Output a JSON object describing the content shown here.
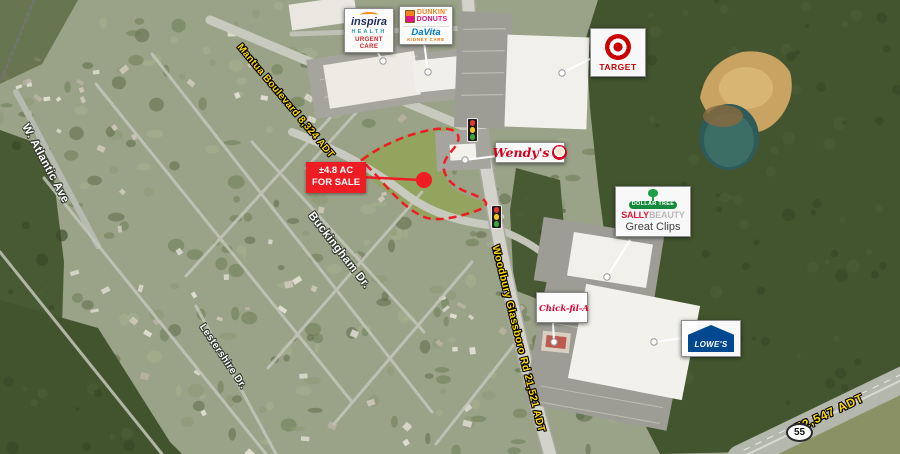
{
  "for_sale": {
    "area": "±4.8 AC",
    "label": "FOR SALE"
  },
  "roads": {
    "mantua": "Mantua Boulevard 8,324 ADT",
    "woodbury": "Woodbury Glassboro Rd 21,521 ADT",
    "highway_adt": "72,547 ADT",
    "route_number": "55"
  },
  "streets": {
    "atlantic": "W. Atlantic Ave",
    "buckingham": "Buckingham Dr.",
    "lestershire": "Lestershire Dr."
  },
  "businesses": {
    "inspira": {
      "name": "inspira",
      "division": "HEALTH",
      "tagline": "URGENT CARE"
    },
    "dunkin": {
      "line1": "DUNKIN'",
      "line2": "DONUTS"
    },
    "davita": {
      "name": "DaVita",
      "tagline": "KIDNEY CARE"
    },
    "target": {
      "name": "TARGET"
    },
    "wendys": {
      "name": "Wendy's"
    },
    "dollar_tree": {
      "name": "DOLLAR TREE"
    },
    "sally": {
      "word1": "SALLY",
      "word2": "BEAUTY"
    },
    "great_clips": {
      "name": "Great Clips"
    },
    "chick_fil_a": {
      "name": "Chick-fil-A"
    },
    "lowes": {
      "name": "LOWE'S"
    }
  },
  "icons": {
    "traffic-light-icon": "css-traffic-light",
    "target-bullseye-icon": "css-concentric-circles",
    "wendys-face-icon": "css-circle-face",
    "dunkin-cup-icon": "css-two-tone-cup",
    "dollar-tree-icon": "css-green-tree",
    "inspira-swoosh-icon": "css-orange-arc",
    "route-55-shield": "css-ellipse-shield",
    "sale-marker-dot": "css-red-circle",
    "leader-dot": "css-white-circle"
  },
  "colors": {
    "sale_red": "#ee1c23",
    "road_label_yellow": "#ffd800",
    "street_label_white": "#ffffff",
    "target_red": "#cc0000",
    "dunkin_orange": "#f5821f",
    "dunkin_pink": "#e11383",
    "davita_blue": "#0077c8",
    "dollar_tree_green": "#17893d",
    "sally_red": "#e31837",
    "lowes_blue": "#004990",
    "wendys_red": "#d6001c",
    "inspira_navy": "#1d2d5c"
  }
}
